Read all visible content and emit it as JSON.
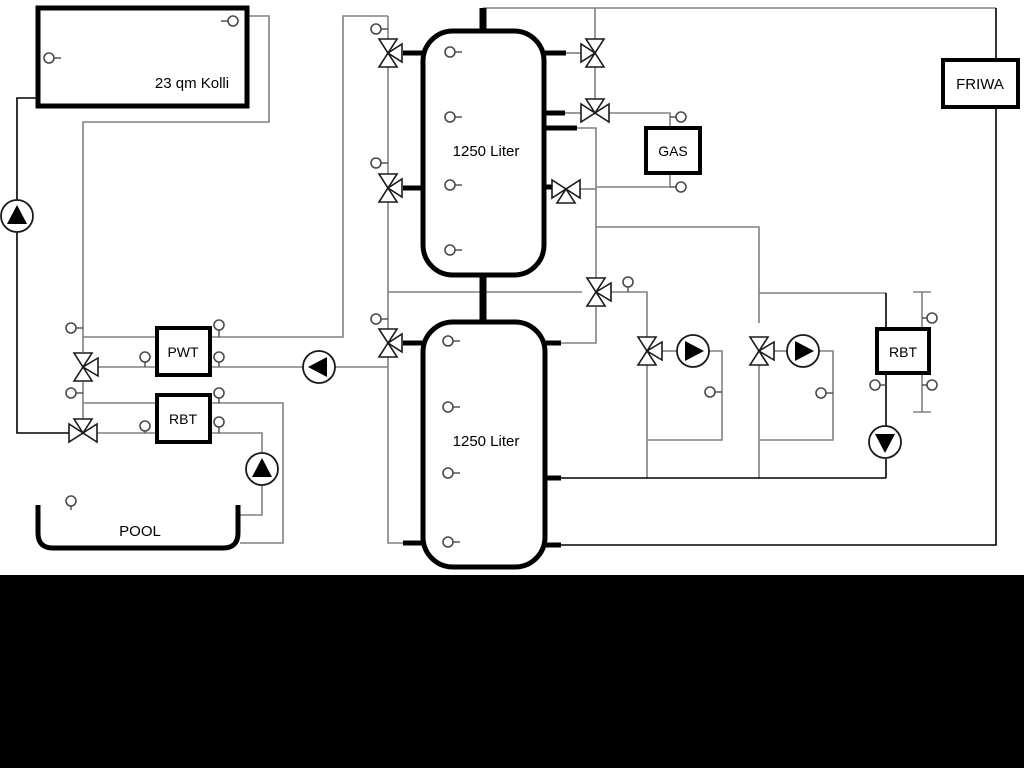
{
  "diagram": {
    "collector": {
      "label": "23 qm Kolli"
    },
    "tank1": {
      "label": "1250 Liter"
    },
    "tank2": {
      "label": "1250 Liter"
    },
    "pwt": {
      "label": "PWT"
    },
    "rbt_left": {
      "label": "RBT"
    },
    "rbt_right": {
      "label": "RBT"
    },
    "gas": {
      "label": "GAS"
    },
    "friwa": {
      "label": "FRIWA"
    },
    "pool": {
      "label": "POOL"
    },
    "colors": {
      "pipe_gray": "#808080",
      "pipe_black": "#000000",
      "background": "#ffffff",
      "bottom_band": "#000000"
    }
  }
}
